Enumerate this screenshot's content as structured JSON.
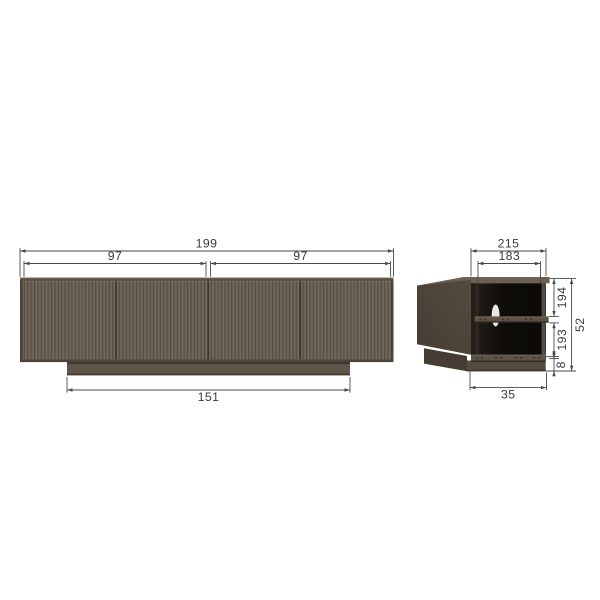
{
  "drawing": {
    "title": "sideboard dimension drawing",
    "front_view": {
      "label": "front elevation",
      "dims": {
        "total_width": "199",
        "left_section_width": "97",
        "right_section_width": "97",
        "plinth_width": "151"
      }
    },
    "side_view": {
      "label": "side view (open back)",
      "dims": {
        "top_depth": "215",
        "inner_depth": "183",
        "upper_inner_height": "194",
        "lower_inner_height": "193",
        "plinth_height": "8",
        "overall_height": "52",
        "plinth_depth": "35"
      }
    },
    "colors": {
      "background": "#ffffff",
      "dim_line": "#4a4a4a",
      "dim_text": "#3a3a3a",
      "door_base": "#6a5f53",
      "door_groove": "#544a40",
      "door_highlight": "#746a5c",
      "top_edge": "#5b5146",
      "top_edge_highlight": "#7b7061",
      "body_edge": "#494137",
      "bottom_edge": "#4c433a",
      "plinth": "#5f5548",
      "plinth_shadow": "#3e3730",
      "plinth_bottom": "#453d33",
      "side_panel_dark": "#453d34",
      "side_panel_light": "#554a3f",
      "top_surface": "#6b6153",
      "frame_edge": "#574d42",
      "shelf": "#5c5245",
      "shelf_top": "#6f6456",
      "rail": "#5d5347",
      "interior_dark": "#0b0a08",
      "interior_light": "#251f18",
      "screw_dot": "#352e27",
      "cable_hole": "#f3f1ec",
      "plinth_front_side": "#554b40"
    }
  }
}
